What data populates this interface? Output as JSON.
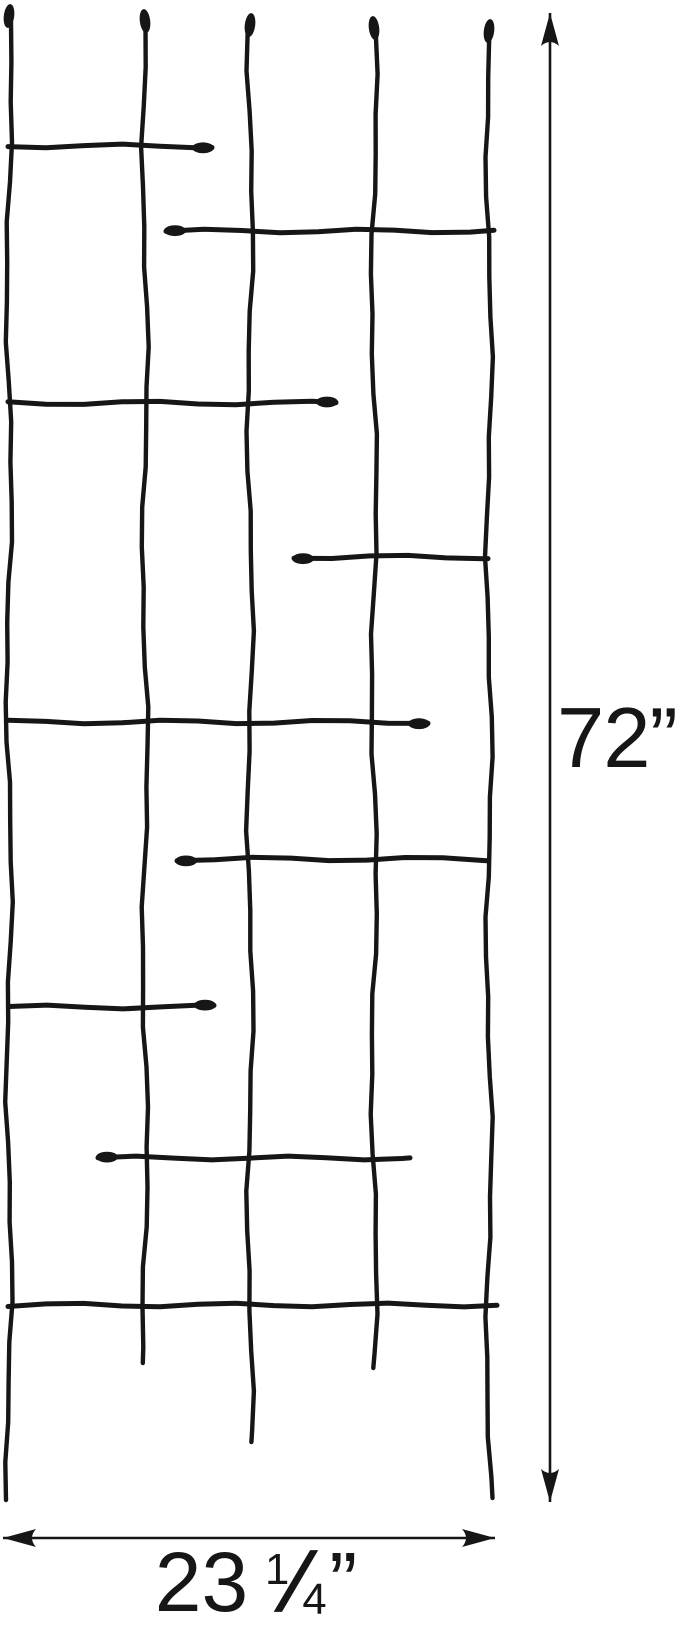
{
  "page": {
    "background": "#ffffff",
    "description_label": "Wire garden trellis dimension diagram"
  },
  "labels": {
    "height": "72”",
    "width_whole": "23",
    "width_frac_numerator": "1",
    "width_frac_slash": "/",
    "width_frac_denominator": "4",
    "width_unit": "”",
    "width_full": "23 ¼”"
  },
  "diagram": {
    "ink_color": "#161616",
    "canvas": {
      "width": 679,
      "height": 1616
    },
    "wire_stroke_width": 4.4,
    "bar_stroke_width": 5,
    "dimension_stroke_width": 2.6,
    "wires": [
      {
        "x": 9,
        "tip_y": 16,
        "bottom": 1500
      },
      {
        "x": 145,
        "tip_y": 21,
        "bottom": 1363
      },
      {
        "x": 250,
        "tip_y": 25,
        "bottom": 1442
      },
      {
        "x": 374,
        "tip_y": 28,
        "bottom": 1368
      },
      {
        "x": 489,
        "tip_y": 31,
        "bottom": 1498
      }
    ],
    "bars": [
      {
        "y": 146,
        "x1": 8,
        "x2": 212,
        "bud": "right"
      },
      {
        "y": 231,
        "x1": 166,
        "x2": 494,
        "bud": "left"
      },
      {
        "y": 403,
        "x1": 8,
        "x2": 336,
        "bud": "right"
      },
      {
        "y": 557,
        "x1": 294,
        "x2": 488,
        "bud": "left"
      },
      {
        "y": 722,
        "x1": 8,
        "x2": 428,
        "bud": "right"
      },
      {
        "y": 859,
        "x1": 177,
        "x2": 487,
        "bud": "left"
      },
      {
        "y": 1007,
        "x1": 9,
        "x2": 214,
        "bud": "right"
      },
      {
        "y": 1158,
        "x1": 98,
        "x2": 410,
        "bud": "none_right_bud_left"
      },
      {
        "y": 1305,
        "x1": 8,
        "x2": 497,
        "bud": "none"
      }
    ],
    "dimension_vertical": {
      "x": 550,
      "y1": 13,
      "y2": 1502
    },
    "dimension_horizontal": {
      "y": 1538,
      "x1": 3,
      "x2": 495
    }
  }
}
